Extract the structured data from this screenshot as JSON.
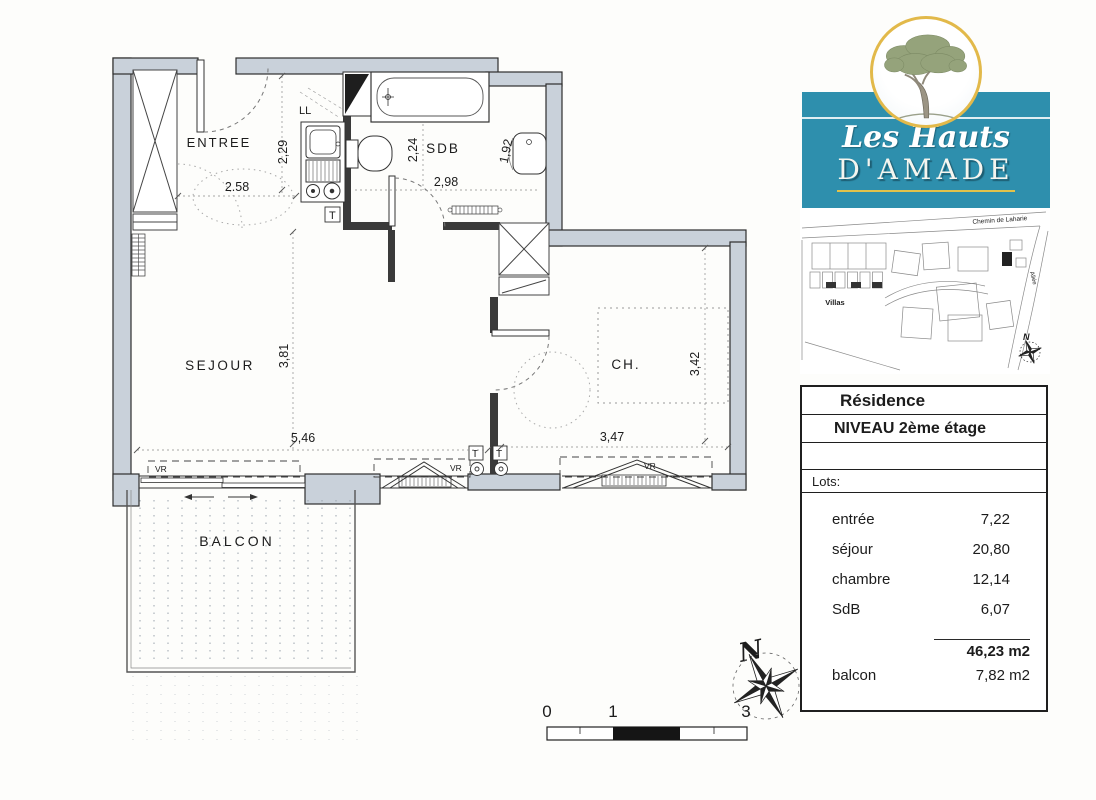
{
  "logo": {
    "line1": "Les Hauts",
    "line2": "D'AMADE"
  },
  "site_map": {
    "road_top": "Chemin de Laharie",
    "road_right": "Allée",
    "villas": "Villas",
    "north": "N"
  },
  "info_table": {
    "title": "Résidence",
    "level": "NIVEAU 2ème étage",
    "lots_label": "Lots:",
    "rows": [
      {
        "label": "entrée",
        "value": "7,22"
      },
      {
        "label": "séjour",
        "value": "20,80"
      },
      {
        "label": "chambre",
        "value": "12,14"
      },
      {
        "label": "SdB",
        "value": "6,07"
      }
    ],
    "total_value": "46,23 m2",
    "balcony_label": "balcon",
    "balcony_value": "7,82 m2"
  },
  "plan": {
    "rooms": {
      "entree": "ENTREE",
      "sejour": "SEJOUR",
      "chambre": "CH.",
      "sdb": "SDB",
      "balcon": "BALCON"
    },
    "fixtures": {
      "washer": "LL",
      "shutter": "VR",
      "tableau": "T"
    },
    "dims": {
      "entree_w": "2.58",
      "entree_h": "2,29",
      "sdb_left_h": "2,24",
      "sdb_w": "2,98",
      "sdb_right_h": "1,92",
      "sejour_h": "3,81",
      "sejour_w": "5,46",
      "ch_w": "3,47",
      "ch_h": "3,42"
    },
    "north": "N",
    "scale": {
      "zero": "0",
      "one": "1",
      "three": "3"
    }
  }
}
